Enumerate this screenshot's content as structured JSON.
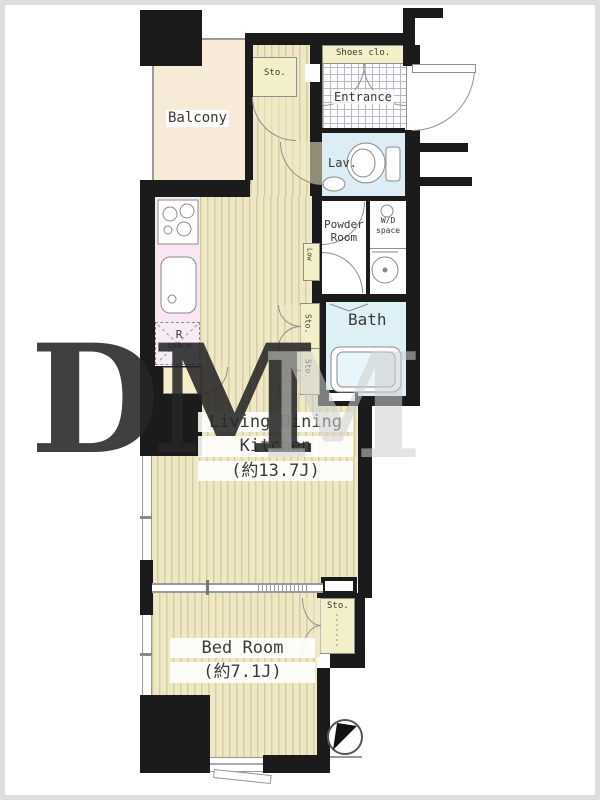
{
  "plan": {
    "type": "apartment-floor-plan",
    "rooms": {
      "balcony": {
        "label": "Balcony"
      },
      "shoes_closet": {
        "label": "Shoes clo."
      },
      "entrance": {
        "label": "Entrance"
      },
      "lavatory": {
        "label": "Lav."
      },
      "wd_space": {
        "label_line1": "W/D",
        "label_line2": "space"
      },
      "powder_room": {
        "label_line1": "Powder",
        "label_line2": "Room"
      },
      "bath": {
        "label": "Bath"
      },
      "ldk": {
        "label_line1": "Living Dining",
        "label_line2": "Kitchen",
        "area": "(約13.7J)"
      },
      "bedroom": {
        "label": "Bed Room",
        "area": "(約7.1J)"
      },
      "refrigerator_space": {
        "label_line1": "R",
        "label_line2": "space"
      },
      "storage_hall": {
        "label": "Sto."
      },
      "storage_mid_upper": {
        "label": "Sto."
      },
      "storage_mid_lower": {
        "label": "Sto."
      },
      "storage_bedroom": {
        "label": "Sto."
      },
      "low_counter": {
        "label": "Low"
      }
    },
    "colors": {
      "wall": "#1b1b1b",
      "floor_base": "#efe8c6",
      "floor_stripe": "#d6cda0",
      "balcony": "#f8ead8",
      "water_rooms": "#dcedf6",
      "kitchen_counter": "#f9e6f5",
      "closet_cream": "#f3efc9",
      "label_text": "#3a3a3a"
    },
    "compass": {
      "type": "north-arrow-pointing-upper-right"
    },
    "watermark": {
      "dark": "DM",
      "light": "M"
    }
  }
}
